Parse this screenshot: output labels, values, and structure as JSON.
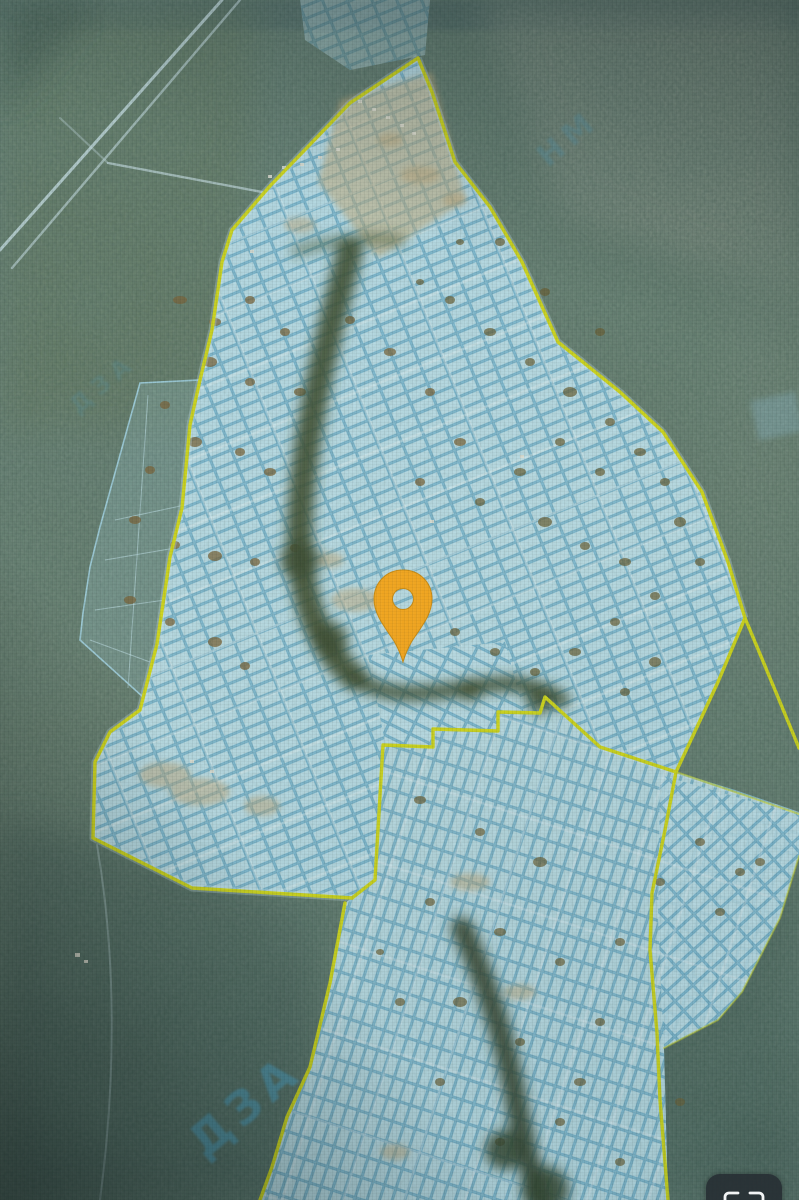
{
  "map_view": {
    "kind": "satellite-cadastral-map",
    "forest_color": "#617C6E",
    "boundary_color": "#D5DC17",
    "parcel": {
      "fill": "#9FD2E4",
      "cell": "#C2E5F0",
      "line": "#69ADCD"
    },
    "pin": {
      "color": "#F2A51D",
      "x": 403,
      "y": 615
    },
    "watermarks": [
      {
        "text": "ДЗА"
      },
      {
        "text": "НМ"
      },
      {
        "text": "ДЗА"
      }
    ],
    "icons": {
      "pin": "location-pin-icon",
      "fullscreen": "fullscreen-expand-icon"
    }
  }
}
